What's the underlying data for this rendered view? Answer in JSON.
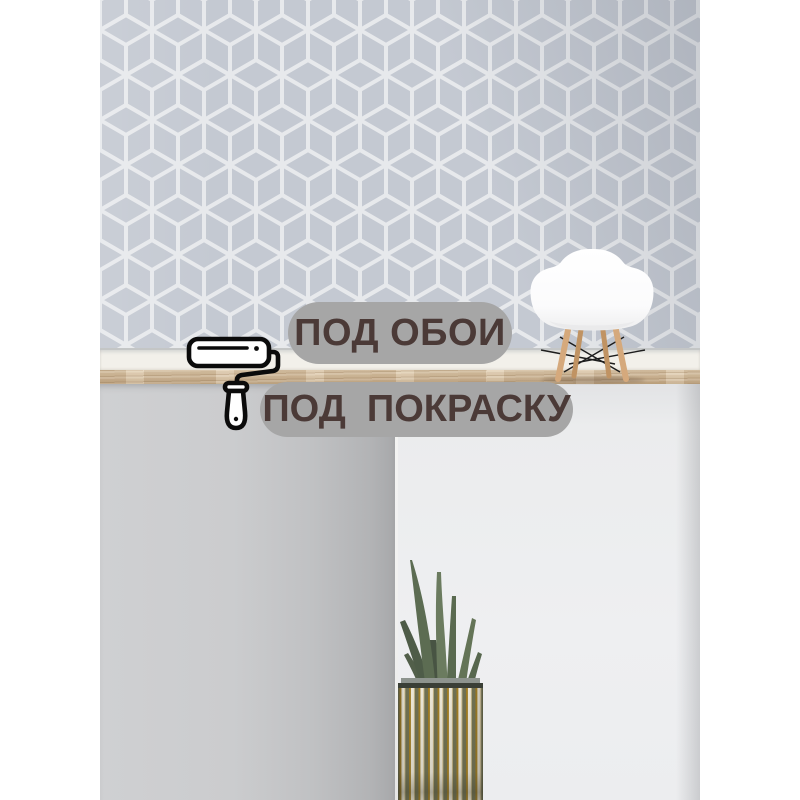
{
  "badges": [
    {
      "id": "wallpaper-use",
      "label": "ПОД ОБОИ"
    },
    {
      "id": "paint-use",
      "label": "ПОД  ПОКРАСКУ"
    }
  ],
  "icons": [
    {
      "name": "paint-roller-icon",
      "style": "black outline"
    }
  ],
  "scene_objects": [
    "geometric-cube-wallpaper",
    "white-baseboard",
    "wood-floor-strip",
    "white-shell-chair-with-wood-legs",
    "gray-lower-wall-panels",
    "aloe-plant-in-ribbed-pot"
  ],
  "colors": {
    "badge_bg": "#a6a6a6",
    "badge_text": "#4b3a37",
    "wallpaper_base": "#c4c9d2",
    "wallpaper_line": "#e7e9ec",
    "baseboard": "#f2f0ea",
    "wood_floor": "#d6c0a2",
    "wall_left_panel": "#c3c4c6",
    "wall_right": "#eceded",
    "chair_shell": "#fdfdfd",
    "chair_legs": "#d2a67a",
    "plant_leaf": "#5c6c52",
    "pot_stripe_cream": "#ece7d8",
    "pot_stripe_olive": "#6f7052",
    "pot_stripe_gold": "#a07c22"
  }
}
